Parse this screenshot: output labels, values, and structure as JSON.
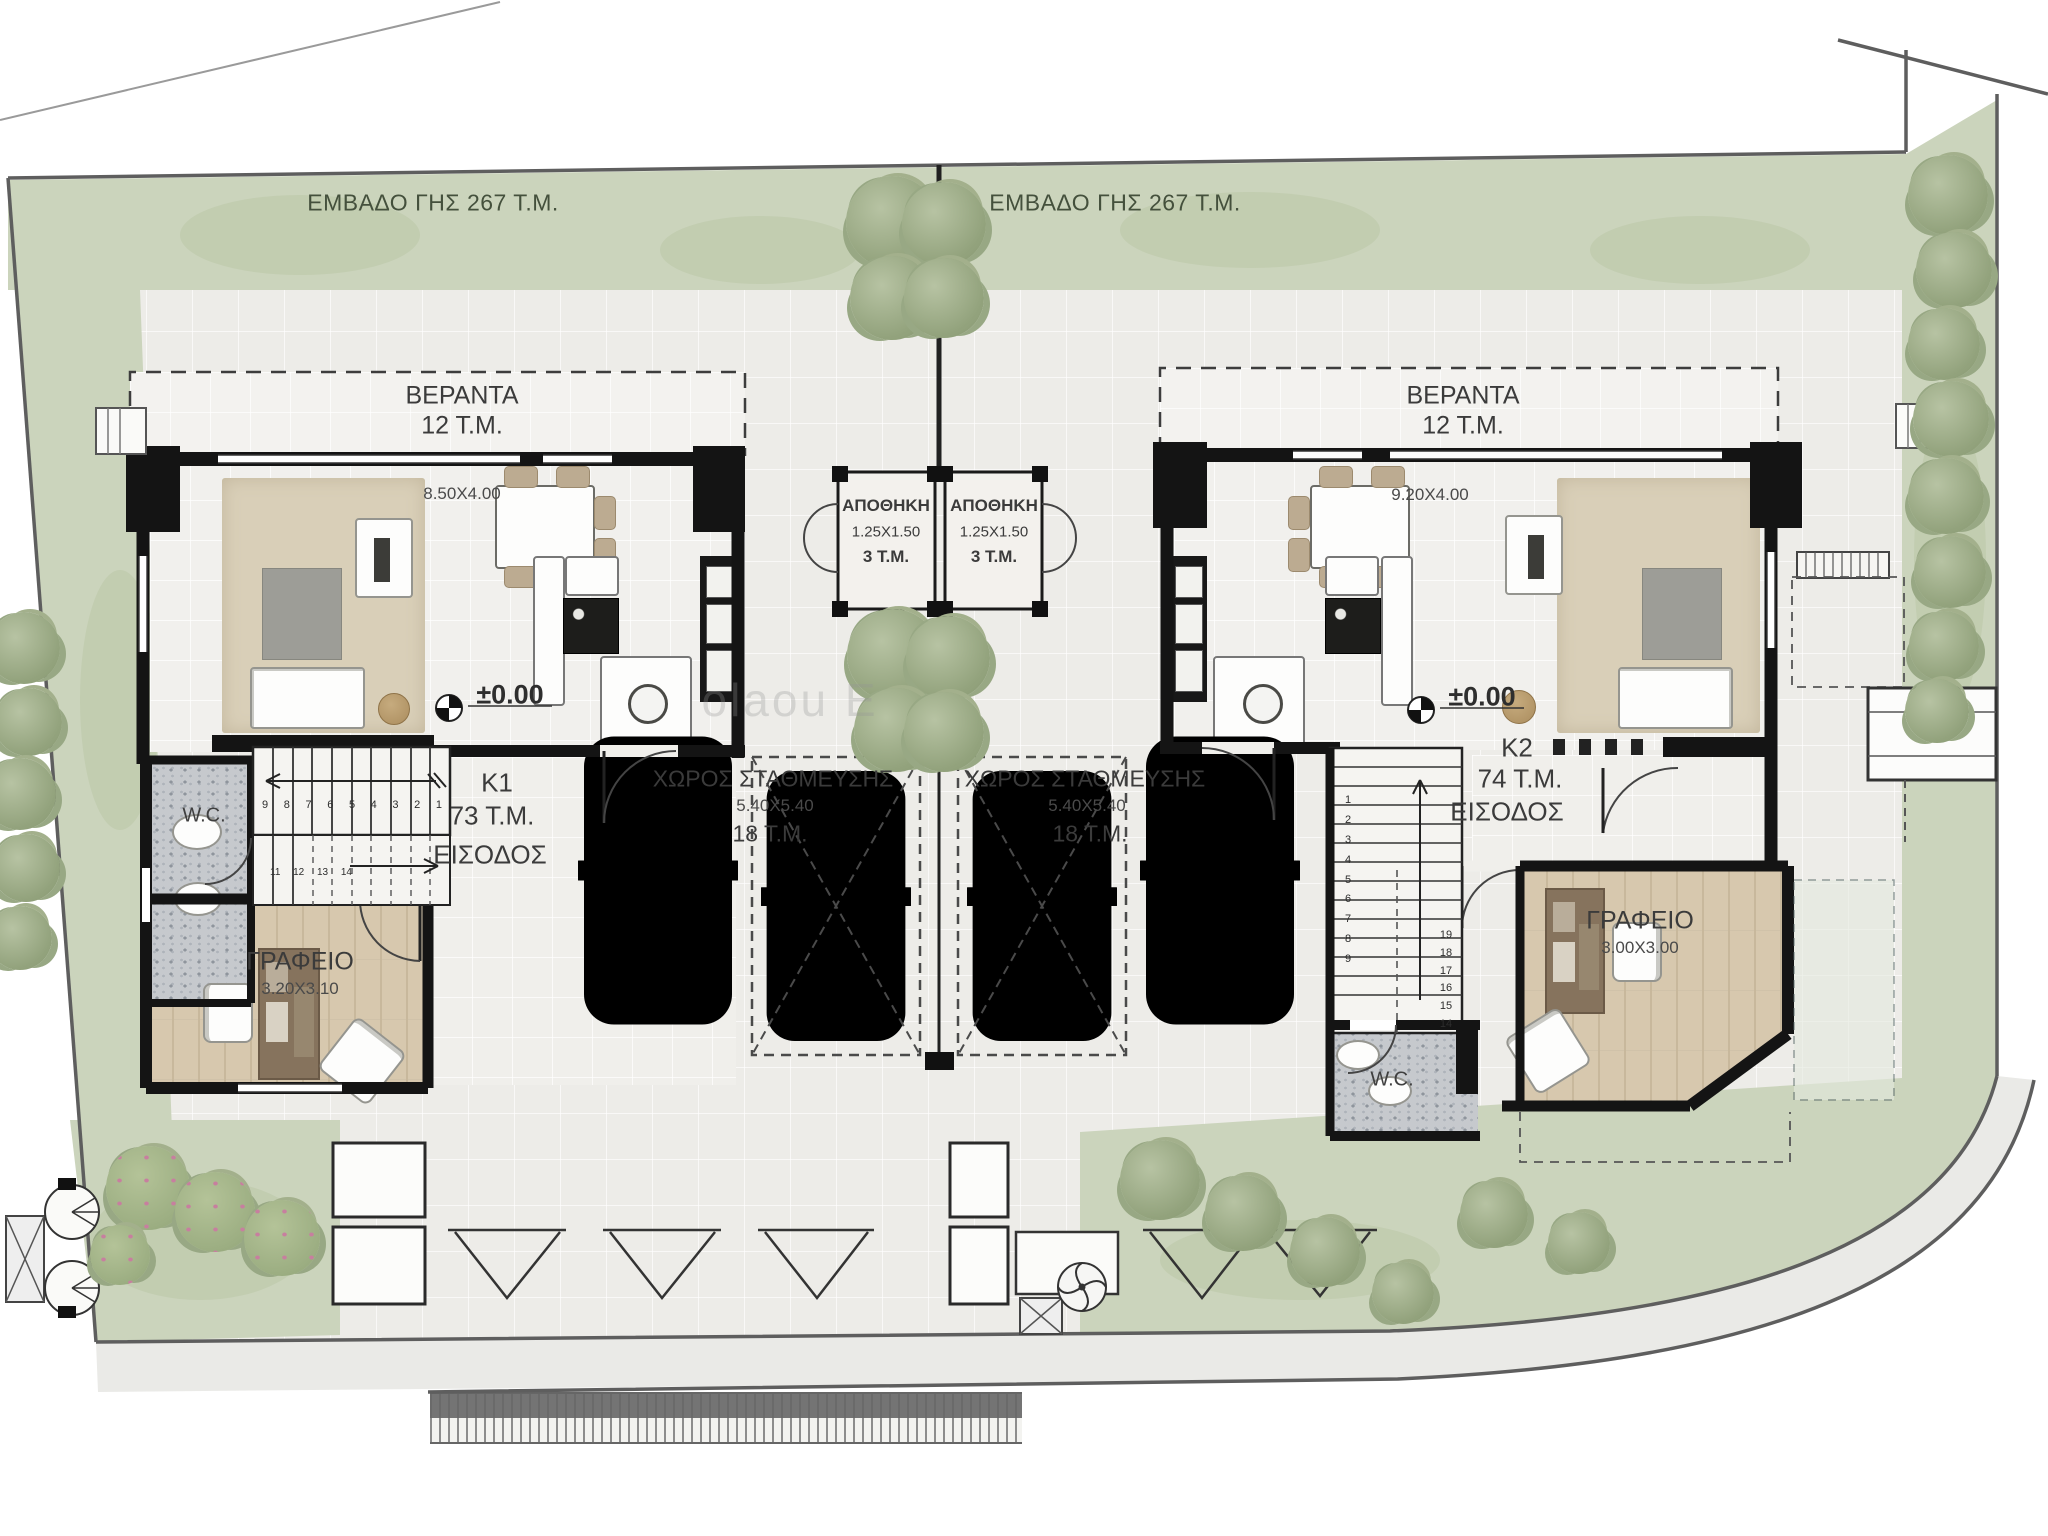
{
  "plot_left": {
    "area_label": "ΕΜΒΑΔΟ ΓΗΣ 267 Τ.Μ."
  },
  "plot_right": {
    "area_label": "ΕΜΒΑΔΟ ΓΗΣ 267 Τ.Μ."
  },
  "watermark": "olaou E",
  "k1": {
    "veranda_name": "ΒΕΡΑΝΤΑ",
    "veranda_area": "12 Τ.Μ.",
    "living_dim": "8.50X4.00",
    "level": "±0.00",
    "unit": "K1",
    "unit_area": "73 Τ.Μ.",
    "entrance": "ΕΙΣΟΔΟΣ",
    "wc": "W.C.",
    "office_name": "ΓΡΑΦΕΙΟ",
    "office_dim": "3.20X3.10",
    "storage_name": "ΑΠΟΘΗΚΗ",
    "storage_dim": "1.25X1.50",
    "storage_area": "3 Τ.Μ.",
    "parking_name": "ΧΩΡΟΣ ΣΤΑΘΜΕΥΣΗΣ",
    "parking_dim": "5.40X5.40",
    "parking_area": "18 Τ.Μ.",
    "stair_run_upper": [
      "9",
      "8",
      "7",
      "6",
      "5",
      "4",
      "3",
      "2",
      "1"
    ],
    "stair_run_lower": [
      "11",
      "12",
      "13",
      "14"
    ]
  },
  "k2": {
    "veranda_name": "ΒΕΡΑΝΤΑ",
    "veranda_area": "12 Τ.Μ.",
    "living_dim": "9.20X4.00",
    "level": "±0.00",
    "unit": "K2",
    "unit_area": "74 Τ.Μ.",
    "entrance": "ΕΙΣΟΔΟΣ",
    "wc": "W.C.",
    "office_name": "ΓΡΑΦΕΙΟ",
    "office_dim": "3.00X3.00",
    "storage_name": "ΑΠΟΘΗΚΗ",
    "storage_dim": "1.25X1.50",
    "storage_area": "3 Τ.Μ.",
    "parking_name": "ΧΩΡΟΣ ΣΤΑΘΜΕΥΣΗΣ",
    "parking_dim": "5.40X5.40",
    "parking_area": "18 Τ.Μ.",
    "stair_col_inner": [
      "1",
      "2",
      "3",
      "4",
      "5",
      "6",
      "7",
      "8",
      "9"
    ],
    "stair_col_outer": [
      "19",
      "18",
      "17",
      "16",
      "15",
      "14"
    ]
  },
  "colors": {
    "landscape": "#cbd4bc",
    "tree": "#93a37d",
    "wall": "#161616",
    "paving": "#edece8",
    "wood": "#d7c8ae",
    "mosaic": "#c6c9cd",
    "road": "#eaeae7"
  }
}
